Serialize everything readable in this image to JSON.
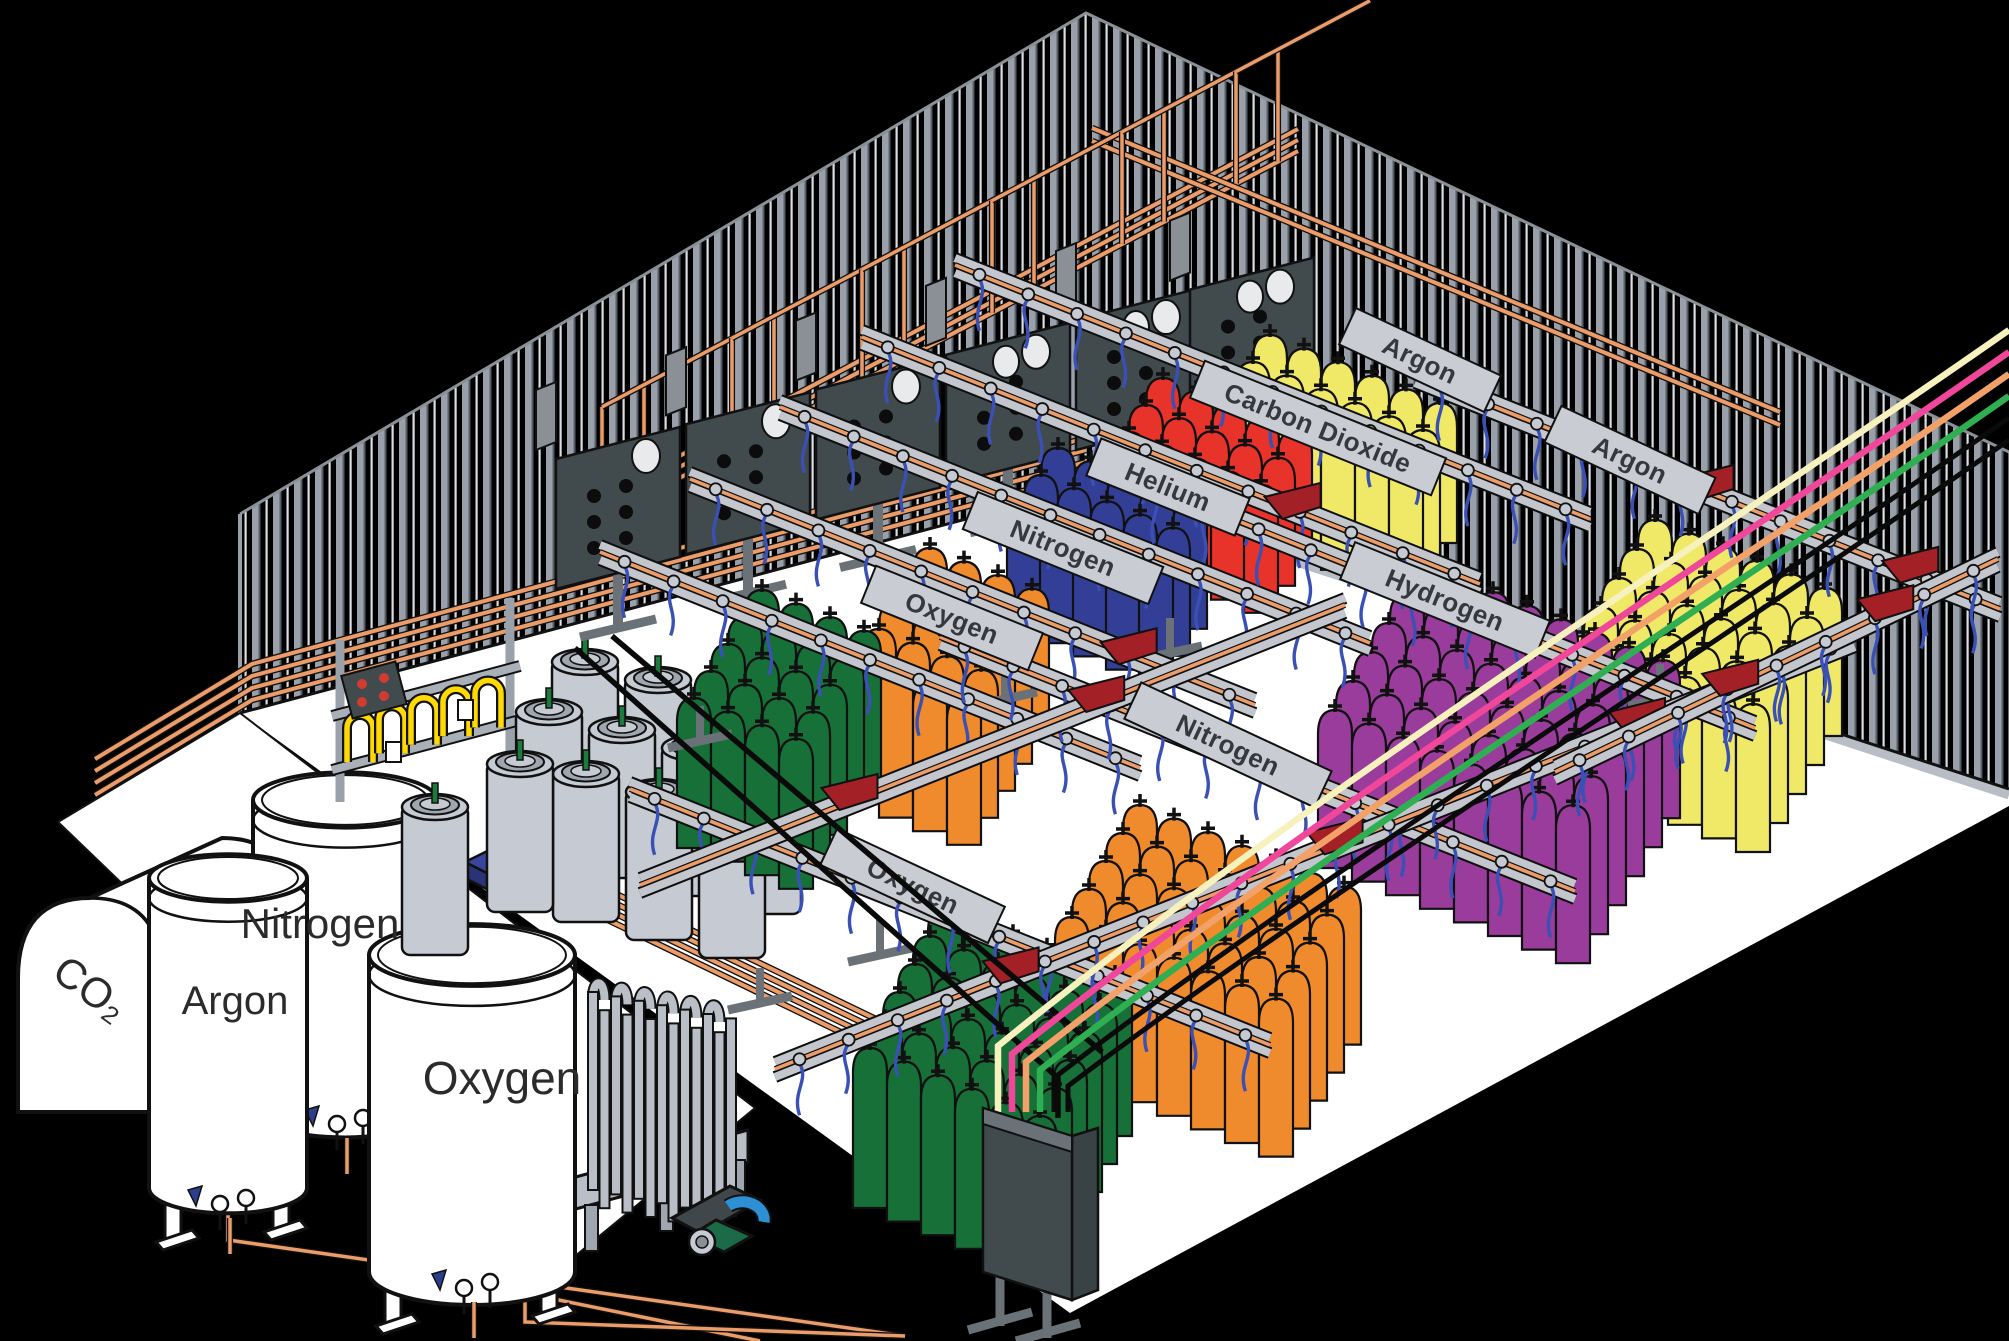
{
  "title": "Industrial gas cylinder filling plant",
  "signs": {
    "oxygen_upper": "Oxygen",
    "nitrogen_upper": "Nitrogen",
    "helium": "Helium",
    "carbon_dioxide": "Carbon Dioxide",
    "argon_top": "Argon",
    "hydrogen": "Hydrogen",
    "nitrogen_mid": "Nitrogen",
    "oxygen_lower": "Oxygen",
    "argon_right": "Argon"
  },
  "tanks": {
    "co2": "CO₂",
    "argon": "Argon",
    "nitrogen": "Nitrogen",
    "oxygen": "Oxygen"
  },
  "colors": {
    "background": "#000000",
    "floor": "#ffffff",
    "wall_stripe": "#99a0aa",
    "wall_stripe_light": "#dadde2",
    "copper": "#eb9c68",
    "rail_gray": "#c3c7cd",
    "sign_gray": "#c9ccd2",
    "trolley_red": "#a32126",
    "oxygen_green": "#177038",
    "nitrogen_orange": "#ef8b2d",
    "nitrogen_blue": "#333f96",
    "helium_red": "#e8332a",
    "co2_yellow": "#f0e968",
    "hydrogen_purple": "#993c9c",
    "dewar_gray": "#c6cad3",
    "panel_dark": "#414b4d",
    "panel_side": "#8a9096",
    "pallet_blue": "#3a449a",
    "pigtail_yellow": "#ffd903",
    "hose_blue": "#3a50b4",
    "line_yellow": "#f6f1bd",
    "line_pink": "#f0479a",
    "line_orange": "#f2a269",
    "line_green": "#2fae52",
    "pump_blue": "#2d8fd4",
    "pump_green": "#1c6b47",
    "button_red": "#d23b2f",
    "valve_green": "#1c7a3c"
  }
}
